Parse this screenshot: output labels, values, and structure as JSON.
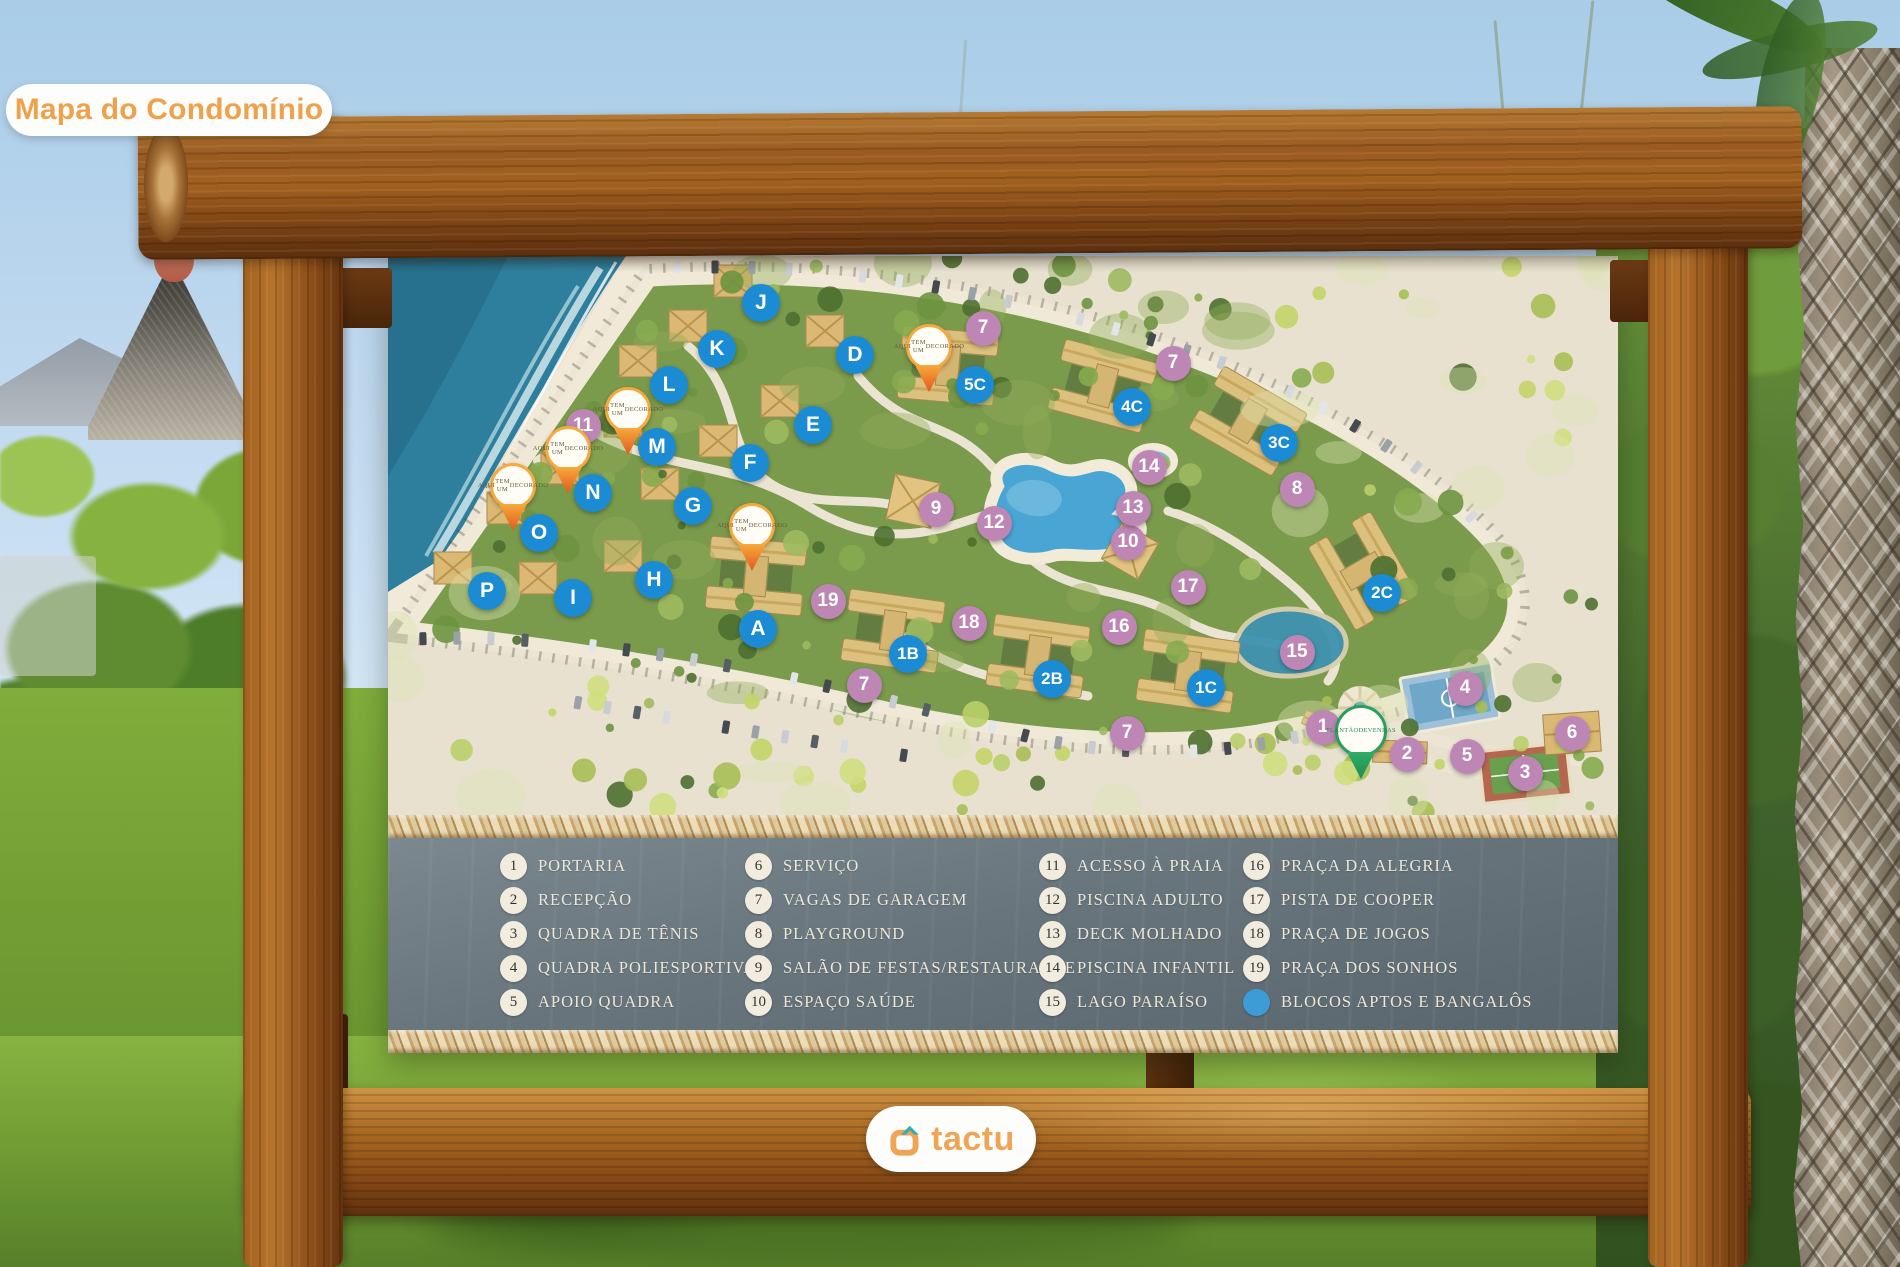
{
  "badge_label": "Mapa do Condomínio",
  "brand": {
    "name": "tactu",
    "icon": "tactu-house-logo"
  },
  "colors": {
    "badge_text": "#f0a14b",
    "brand_orange": "#f0a455",
    "brand_teal": "#3aacb8",
    "marker_blue": "#1b8bd4",
    "marker_purple": "#bd86b5",
    "legend_dot_blue": "#3d9bd6",
    "pin_orange": "#f5a93e",
    "pin_green": "#27a05e"
  },
  "map": {
    "decorado_pin_label": "AQUI TEM UM DECORADO",
    "sales_pin_label": "PLANTÃO DE VENDAS",
    "letter_markers": [
      {
        "label": "J",
        "x": 761,
        "y": 303
      },
      {
        "label": "K",
        "x": 717,
        "y": 349
      },
      {
        "label": "L",
        "x": 669,
        "y": 385
      },
      {
        "label": "M",
        "x": 657,
        "y": 447
      },
      {
        "label": "N",
        "x": 593,
        "y": 493
      },
      {
        "label": "O",
        "x": 539,
        "y": 533
      },
      {
        "label": "P",
        "x": 487,
        "y": 591
      },
      {
        "label": "I",
        "x": 573,
        "y": 598
      },
      {
        "label": "H",
        "x": 654,
        "y": 580
      },
      {
        "label": "G",
        "x": 693,
        "y": 506
      },
      {
        "label": "F",
        "x": 750,
        "y": 463
      },
      {
        "label": "E",
        "x": 813,
        "y": 425
      },
      {
        "label": "D",
        "x": 855,
        "y": 355
      },
      {
        "label": "A",
        "x": 758,
        "y": 629
      },
      {
        "label": "1B",
        "x": 908,
        "y": 654
      },
      {
        "label": "2B",
        "x": 1052,
        "y": 679
      },
      {
        "label": "1C",
        "x": 1206,
        "y": 688
      },
      {
        "label": "2C",
        "x": 1382,
        "y": 593
      },
      {
        "label": "3C",
        "x": 1279,
        "y": 443
      },
      {
        "label": "4C",
        "x": 1132,
        "y": 407
      },
      {
        "label": "5C",
        "x": 975,
        "y": 385
      }
    ],
    "number_markers": [
      {
        "label": "1",
        "x": 1323,
        "y": 727
      },
      {
        "label": "2",
        "x": 1407,
        "y": 754
      },
      {
        "label": "3",
        "x": 1525,
        "y": 773
      },
      {
        "label": "4",
        "x": 1465,
        "y": 688
      },
      {
        "label": "5",
        "x": 1467,
        "y": 756
      },
      {
        "label": "6",
        "x": 1572,
        "y": 733
      },
      {
        "label": "7",
        "x": 983,
        "y": 328
      },
      {
        "label": "7",
        "x": 1173,
        "y": 363
      },
      {
        "label": "7",
        "x": 864,
        "y": 685
      },
      {
        "label": "7",
        "x": 1127,
        "y": 733
      },
      {
        "label": "8",
        "x": 1297,
        "y": 489
      },
      {
        "label": "9",
        "x": 936,
        "y": 509
      },
      {
        "label": "10",
        "x": 1128,
        "y": 542
      },
      {
        "label": "11",
        "x": 583,
        "y": 426
      },
      {
        "label": "12",
        "x": 994,
        "y": 523
      },
      {
        "label": "13",
        "x": 1133,
        "y": 508
      },
      {
        "label": "14",
        "x": 1149,
        "y": 467
      },
      {
        "label": "15",
        "x": 1297,
        "y": 652
      },
      {
        "label": "16",
        "x": 1119,
        "y": 627
      },
      {
        "label": "17",
        "x": 1188,
        "y": 587
      },
      {
        "label": "18",
        "x": 969,
        "y": 623
      },
      {
        "label": "19",
        "x": 828,
        "y": 601
      }
    ],
    "decorado_pins": [
      {
        "x": 628,
        "y": 410
      },
      {
        "x": 568,
        "y": 449
      },
      {
        "x": 513,
        "y": 486
      },
      {
        "x": 752,
        "y": 526
      },
      {
        "x": 929,
        "y": 347
      }
    ],
    "sales_pin": {
      "x": 1361,
      "y": 731
    }
  },
  "legend": {
    "columns": [
      [
        {
          "num": "1",
          "label": "PORTARIA"
        },
        {
          "num": "2",
          "label": "RECEPÇÃO"
        },
        {
          "num": "3",
          "label": "QUADRA DE TÊNIS"
        },
        {
          "num": "4",
          "label": "QUADRA POLIESPORTIVA"
        },
        {
          "num": "5",
          "label": "APOIO QUADRA"
        }
      ],
      [
        {
          "num": "6",
          "label": "SERVIÇO"
        },
        {
          "num": "7",
          "label": "VAGAS DE GARAGEM"
        },
        {
          "num": "8",
          "label": "PLAYGROUND"
        },
        {
          "num": "9",
          "label": "SALÃO DE FESTAS/RESTAURANTE"
        },
        {
          "num": "10",
          "label": "ESPAÇO SAÚDE"
        }
      ],
      [
        {
          "num": "11",
          "label": "ACESSO À PRAIA"
        },
        {
          "num": "12",
          "label": "PISCINA ADULTO"
        },
        {
          "num": "13",
          "label": "DECK MOLHADO"
        },
        {
          "num": "14",
          "label": "PISCINA INFANTIL"
        },
        {
          "num": "15",
          "label": "LAGO PARAÍSO"
        }
      ],
      [
        {
          "num": "16",
          "label": "PRAÇA DA ALEGRIA"
        },
        {
          "num": "17",
          "label": "PISTA DE COOPER"
        },
        {
          "num": "18",
          "label": "PRAÇA DE JOGOS"
        },
        {
          "num": "19",
          "label": "PRAÇA DOS SONHOS"
        },
        {
          "dot": true,
          "label": "BLOCOS APTOS E BANGALÔS"
        }
      ]
    ]
  }
}
